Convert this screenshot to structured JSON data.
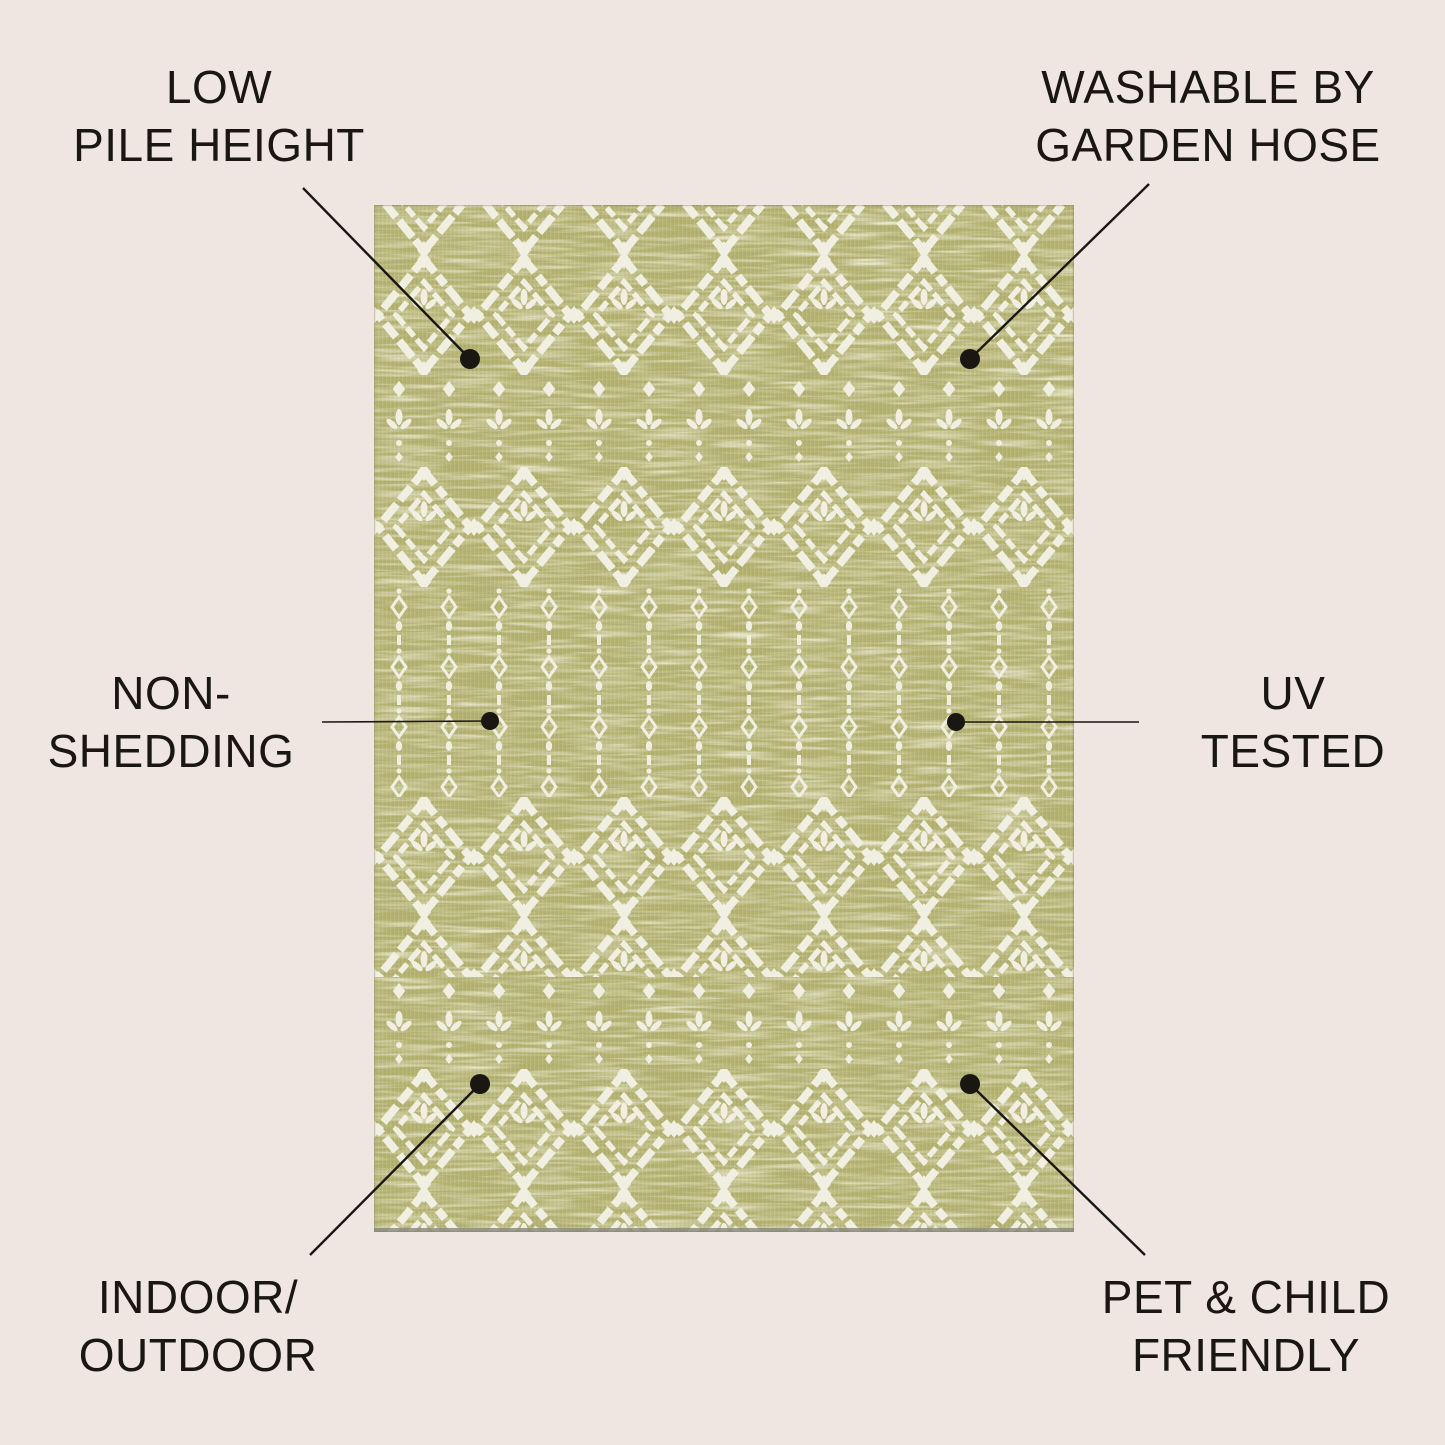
{
  "page": {
    "background_color": "#efe6e1",
    "text_color": "#1a1713"
  },
  "rug": {
    "description": "green-and-ivory-moroccan-trellis-outdoor-rug",
    "base_color": "#b2b06c",
    "motif_color": "#f1efe2",
    "edge_shadow_color": "#8f8e82"
  },
  "callouts": [
    {
      "id": "low-pile-height",
      "text": "LOW\nPILE HEIGHT",
      "line": {
        "x1": 303,
        "y1": 188,
        "x2": 470,
        "y2": 359,
        "width": 2.4
      },
      "dot": {
        "x": 470,
        "y": 359,
        "r": 10
      }
    },
    {
      "id": "washable-by-garden-hose",
      "text": "WASHABLE BY\nGARDEN HOSE",
      "line": {
        "x1": 1149,
        "y1": 184,
        "x2": 970,
        "y2": 359,
        "width": 2.4
      },
      "dot": {
        "x": 970,
        "y": 359,
        "r": 10
      }
    },
    {
      "id": "non-shedding",
      "text": "NON-\nSHEDDING",
      "line": {
        "x1": 322,
        "y1": 722,
        "x2": 490,
        "y2": 721,
        "width": 1.6
      },
      "dot": {
        "x": 490,
        "y": 721,
        "r": 9
      }
    },
    {
      "id": "uv-tested",
      "text": "UV\nTESTED",
      "line": {
        "x1": 1139,
        "y1": 722,
        "x2": 956,
        "y2": 722,
        "width": 1.6
      },
      "dot": {
        "x": 956,
        "y": 722,
        "r": 9
      }
    },
    {
      "id": "indoor-outdoor",
      "text": "INDOOR/\nOUTDOOR",
      "line": {
        "x1": 310,
        "y1": 1255,
        "x2": 480,
        "y2": 1084,
        "width": 2.4
      },
      "dot": {
        "x": 480,
        "y": 1084,
        "r": 10
      }
    },
    {
      "id": "pet-child-friendly",
      "text": "PET & CHILD\nFRIENDLY",
      "line": {
        "x1": 1145,
        "y1": 1255,
        "x2": 970,
        "y2": 1084,
        "width": 2.4
      },
      "dot": {
        "x": 970,
        "y": 1084,
        "r": 10
      }
    }
  ]
}
